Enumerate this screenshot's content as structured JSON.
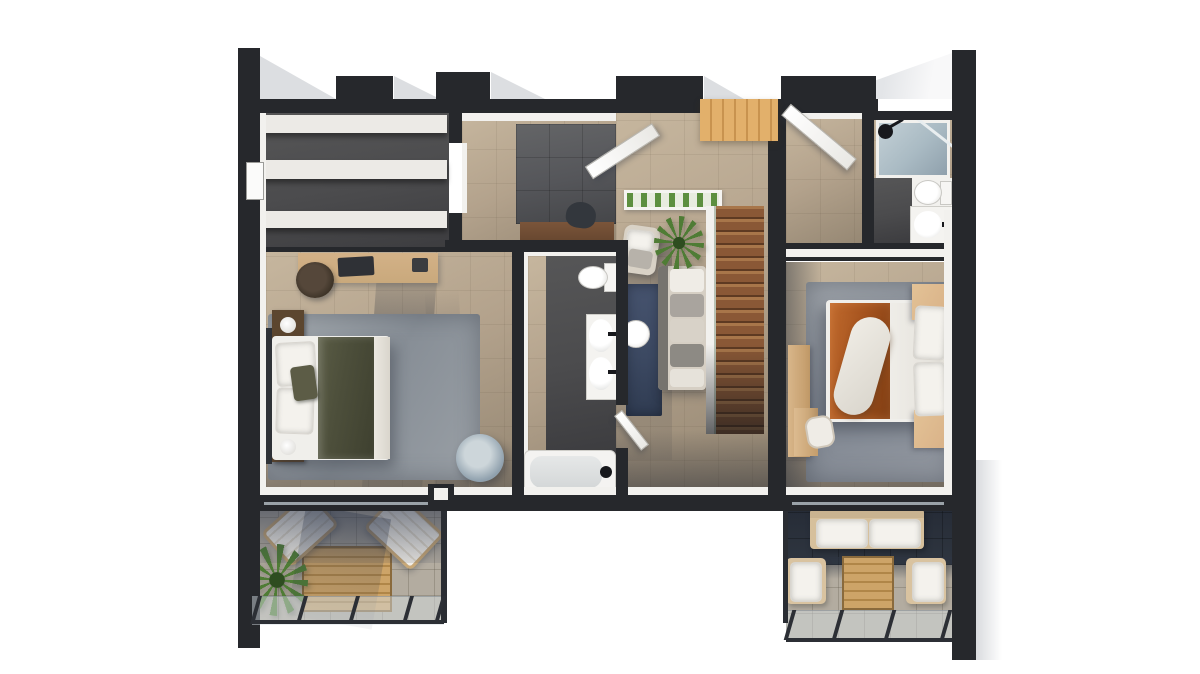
{
  "scene": {
    "render_type": "top-down 3D architectural floor plan rendering",
    "floor": "upper floor with two bedrooms, two bathrooms, staircase and two terraces",
    "visible_text": "none",
    "rooms": [
      {
        "name": "walk-in-closet",
        "objects": [
          "wardrobe-shelves"
        ]
      },
      {
        "name": "left-bedroom",
        "objects": [
          "double-bed",
          "olive-blanket",
          "pillows",
          "headboard",
          "nightstand-with-lamp",
          "nightstand-with-lamp",
          "desk",
          "office-chair",
          "armchair",
          "gray-area-rug"
        ]
      },
      {
        "name": "upper-hall",
        "objects": [
          "vanity-desk",
          "stool"
        ]
      },
      {
        "name": "central-bathroom",
        "objects": [
          "toilet",
          "double-sink-vanity",
          "bathtub"
        ]
      },
      {
        "name": "hallway",
        "objects": [
          "navy-runner-rug",
          "round-side-table"
        ]
      },
      {
        "name": "living-landing",
        "objects": [
          "sofa",
          "armchair",
          "potted-plant",
          "glass-planter-shelf"
        ]
      },
      {
        "name": "staircase",
        "objects": [
          "wood-treads",
          "glass-railing"
        ]
      },
      {
        "name": "entry",
        "objects": [
          "double-entry-doors",
          "wood-threshold"
        ]
      },
      {
        "name": "ensuite-bathroom",
        "objects": [
          "glass-shower",
          "shower-head",
          "toilet",
          "sink"
        ]
      },
      {
        "name": "right-bedroom",
        "objects": [
          "double-bed",
          "orange-duvet",
          "pillows",
          "white-throw",
          "nightstand",
          "nightstand",
          "desk",
          "chair",
          "gray-area-rug"
        ]
      },
      {
        "name": "left-terrace",
        "objects": [
          "sun-lounger",
          "sun-lounger",
          "wood-deck-table",
          "potted-palm",
          "glass-balustrade"
        ]
      },
      {
        "name": "right-terrace",
        "objects": [
          "outdoor-sofa",
          "outdoor-armchair",
          "outdoor-armchair",
          "wood-coffee-table",
          "glass-balustrade"
        ]
      }
    ]
  },
  "palette": {
    "bg": "#ffffff",
    "wall": "#26282c",
    "lining": "#f2f1ee",
    "floor": "#b3a28c",
    "floor-light": "#c6b69e",
    "floor-dark": "#948672",
    "slate": "#55565a",
    "closet-floor": "#4b4b4d",
    "shelf-white": "#eceae6",
    "wood-stairs": "#8a5836",
    "wood-entry": "#d8a55e",
    "wood-deck": "#c1975c",
    "wood-desk": "#c9a97c",
    "wood-dark": "#5c462f",
    "wood-tan": "#d9b288",
    "rug-gray": "#969da4",
    "rug-blue": "#3c4962",
    "bed-white": "#f0efeb",
    "blanket-olive": "#4d4f3b",
    "duvet-orange": "#a5531e",
    "headboard-dark": "#303338",
    "chair-blue": "#8fa0ad",
    "plant-green": "#4f7c35",
    "glass-shower": "#a9bac3",
    "terrace-tile": "#b3aca0",
    "terrace-tile-dark": "#2f3640",
    "frame-tan": "#c8a877",
    "shadow-ext": "#dcdee1",
    "shadow-int": "rgba(42,49,62,0.35)"
  }
}
